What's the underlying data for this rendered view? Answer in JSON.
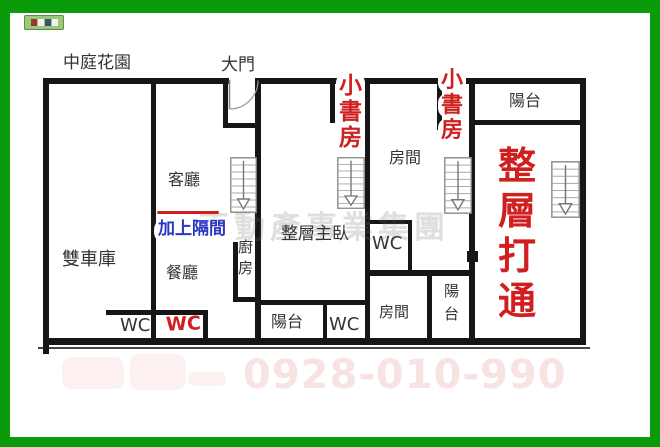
{
  "plan": {
    "labels": {
      "courtyard": "中庭花園",
      "main_gate": "大門",
      "living_room": "客廳",
      "double_garage": "雙車庫",
      "dining_room": "餐廳",
      "kitchen": "廚房",
      "master_suite": "整層主臥",
      "room_upper": "房間",
      "room_lower": "房間",
      "balcony_unit2": "陽台",
      "balcony_unit3": "陽台",
      "balcony_unit4": "陽台",
      "wc_garage": "WC",
      "wc_unit2": "WC",
      "wc_unit3": "WC"
    },
    "annotations": {
      "wc_red": "WC",
      "add_partition": "加上隔間",
      "small_study_1": "小書房",
      "small_study_2": "小書房",
      "whole_floor_open": "整層打通"
    },
    "colors": {
      "frame_green": "#0a9b0a",
      "annotation_red": "#cf1f1f",
      "annotation_blue": "#2a35c0",
      "wall_black": "#161616"
    }
  },
  "watermarks": {
    "company": "不動產事業集團",
    "phone": "0928-010-990"
  }
}
